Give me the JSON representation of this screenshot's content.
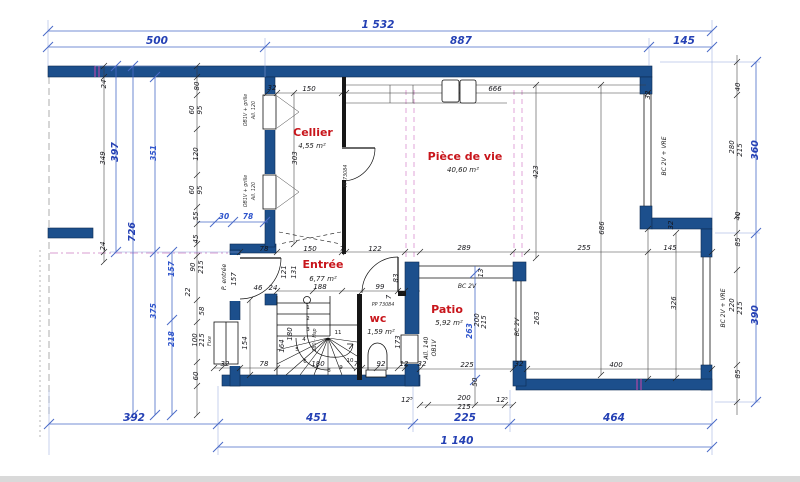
{
  "drawing_type": "floor-plan",
  "colors": {
    "wall": "#1c4f8c",
    "dimension_blue": "#2440b4",
    "room_label_red": "#c8151b"
  },
  "rooms": [
    {
      "name": "Cellier",
      "area": "4,55 m²"
    },
    {
      "name": "Pièce de vie",
      "area": "40,60 m²"
    },
    {
      "name": "Entrée",
      "area": "6,77 m²"
    },
    {
      "name": "wc",
      "area": "1,59 m²"
    },
    {
      "name": "Patio",
      "area": "5,92 m²"
    }
  ],
  "annotations": [
    {
      "t": "1 532",
      "x": 378,
      "y": 28,
      "c": "maj"
    },
    {
      "t": "500",
      "x": 157,
      "y": 44,
      "c": "maj"
    },
    {
      "t": "887",
      "x": 461,
      "y": 44,
      "c": "maj"
    },
    {
      "t": "145",
      "x": 684,
      "y": 44,
      "c": "maj"
    },
    {
      "t": "392",
      "x": 134,
      "y": 421,
      "c": "maj"
    },
    {
      "t": "451",
      "x": 317,
      "y": 421,
      "c": "maj"
    },
    {
      "t": "225",
      "x": 465,
      "y": 421,
      "c": "maj"
    },
    {
      "t": "464",
      "x": 614,
      "y": 421,
      "c": "maj"
    },
    {
      "t": "1 140",
      "x": 457,
      "y": 444,
      "c": "maj"
    },
    {
      "t": "397",
      "x": 118,
      "y": 152,
      "r": -90,
      "c": "majv"
    },
    {
      "t": "726",
      "x": 135,
      "y": 232,
      "r": -90,
      "c": "majv"
    },
    {
      "t": "360",
      "x": 758,
      "y": 150,
      "r": -90,
      "c": "majv"
    },
    {
      "t": "390",
      "x": 758,
      "y": 315,
      "r": -90,
      "c": "majv"
    },
    {
      "t": "351",
      "x": 156,
      "y": 153,
      "r": -90,
      "c": "blu"
    },
    {
      "t": "157",
      "x": 174,
      "y": 269,
      "r": -90,
      "c": "blu"
    },
    {
      "t": "375",
      "x": 156,
      "y": 311,
      "r": -90,
      "c": "blu"
    },
    {
      "t": "218",
      "x": 174,
      "y": 339,
      "r": -90,
      "c": "blu"
    },
    {
      "t": "30",
      "x": 224,
      "y": 219,
      "c": "blu"
    },
    {
      "t": "78",
      "x": 248,
      "y": 219,
      "c": "blu"
    },
    {
      "t": "263",
      "x": 472,
      "y": 331,
      "r": -90,
      "c": "blu"
    },
    {
      "t": "24",
      "x": 106,
      "y": 84,
      "r": -90,
      "c": "dim"
    },
    {
      "t": "349",
      "x": 105,
      "y": 158,
      "r": -90,
      "c": "dim"
    },
    {
      "t": "24",
      "x": 105,
      "y": 246,
      "r": -90,
      "c": "dim"
    },
    {
      "t": "80",
      "x": 199,
      "y": 86,
      "r": -90,
      "c": "dim"
    },
    {
      "t": "60",
      "x": 194,
      "y": 110,
      "r": -90,
      "c": "dim"
    },
    {
      "t": "95",
      "x": 202,
      "y": 110,
      "r": -90,
      "c": "dim"
    },
    {
      "t": "120",
      "x": 198,
      "y": 154,
      "r": -90,
      "c": "dim"
    },
    {
      "t": "60",
      "x": 194,
      "y": 190,
      "r": -90,
      "c": "dim"
    },
    {
      "t": "95",
      "x": 202,
      "y": 190,
      "r": -90,
      "c": "dim"
    },
    {
      "t": "55",
      "x": 198,
      "y": 216,
      "r": -90,
      "c": "dim"
    },
    {
      "t": "45",
      "x": 198,
      "y": 239,
      "r": -90,
      "c": "dim"
    },
    {
      "t": "90",
      "x": 195,
      "y": 267,
      "r": -90,
      "c": "dim"
    },
    {
      "t": "215",
      "x": 203,
      "y": 267,
      "r": -90,
      "c": "dim"
    },
    {
      "t": "22",
      "x": 190,
      "y": 292,
      "r": -90,
      "c": "dim"
    },
    {
      "t": "58",
      "x": 204,
      "y": 311,
      "r": -90,
      "c": "dim"
    },
    {
      "t": "100",
      "x": 197,
      "y": 340,
      "r": -90,
      "c": "dim"
    },
    {
      "t": "215",
      "x": 204,
      "y": 340,
      "r": -90,
      "c": "dim"
    },
    {
      "t": "60",
      "x": 198,
      "y": 376,
      "r": -90,
      "c": "dim"
    },
    {
      "t": "40",
      "x": 740,
      "y": 87,
      "r": -90,
      "c": "dim"
    },
    {
      "t": "280",
      "x": 734,
      "y": 147,
      "r": -90,
      "c": "dim"
    },
    {
      "t": "215",
      "x": 742,
      "y": 150,
      "r": -90,
      "c": "dim"
    },
    {
      "t": "40",
      "x": 740,
      "y": 216,
      "r": -90,
      "c": "dim"
    },
    {
      "t": "85",
      "x": 740,
      "y": 242,
      "r": -90,
      "c": "dim"
    },
    {
      "t": "220",
      "x": 734,
      "y": 305,
      "r": -90,
      "c": "dim"
    },
    {
      "t": "215",
      "x": 742,
      "y": 308,
      "r": -90,
      "c": "dim"
    },
    {
      "t": "85",
      "x": 740,
      "y": 374,
      "r": -90,
      "c": "dim"
    },
    {
      "t": "32",
      "x": 272,
      "y": 90,
      "c": "dim"
    },
    {
      "t": "150",
      "x": 309,
      "y": 91,
      "c": "dim"
    },
    {
      "t": "7",
      "x": 344,
      "y": 91,
      "c": "dim"
    },
    {
      "t": "666",
      "x": 495,
      "y": 91,
      "c": "dim"
    },
    {
      "t": "303",
      "x": 297,
      "y": 158,
      "r": -90,
      "c": "dim"
    },
    {
      "t": "423",
      "x": 538,
      "y": 172,
      "r": -90,
      "c": "dim"
    },
    {
      "t": "686",
      "x": 604,
      "y": 228,
      "r": -90,
      "c": "dim"
    },
    {
      "t": "32",
      "x": 650,
      "y": 95,
      "r": -90,
      "c": "dim"
    },
    {
      "t": "32",
      "x": 673,
      "y": 225,
      "r": -90,
      "c": "dim"
    },
    {
      "t": "145",
      "x": 670,
      "y": 250,
      "c": "dim"
    },
    {
      "t": "326",
      "x": 676,
      "y": 303,
      "r": -90,
      "c": "dim"
    },
    {
      "t": "78",
      "x": 264,
      "y": 251,
      "c": "dim"
    },
    {
      "t": "150",
      "x": 310,
      "y": 251,
      "c": "dim"
    },
    {
      "t": "7",
      "x": 342,
      "y": 251,
      "c": "dim"
    },
    {
      "t": "122",
      "x": 375,
      "y": 251,
      "c": "dim"
    },
    {
      "t": "289",
      "x": 464,
      "y": 250,
      "c": "dim"
    },
    {
      "t": "255",
      "x": 584,
      "y": 250,
      "c": "dim"
    },
    {
      "t": "188",
      "x": 320,
      "y": 289,
      "c": "dim"
    },
    {
      "t": "99",
      "x": 380,
      "y": 289,
      "c": "dim"
    },
    {
      "t": "83",
      "x": 398,
      "y": 278,
      "r": -90,
      "c": "dim"
    },
    {
      "t": "7",
      "x": 391,
      "y": 297,
      "r": -90,
      "c": "dim"
    },
    {
      "t": "46",
      "x": 258,
      "y": 290,
      "c": "dim"
    },
    {
      "t": "24",
      "x": 273,
      "y": 290,
      "c": "dim"
    },
    {
      "t": "121",
      "x": 286,
      "y": 272,
      "r": -90,
      "c": "dim"
    },
    {
      "t": "131",
      "x": 296,
      "y": 272,
      "r": -90,
      "c": "dim"
    },
    {
      "t": "157",
      "x": 236,
      "y": 279,
      "r": -90,
      "c": "dim"
    },
    {
      "t": "154",
      "x": 247,
      "y": 343,
      "r": -90,
      "c": "dim"
    },
    {
      "t": "164",
      "x": 284,
      "y": 346,
      "r": -90,
      "c": "dim"
    },
    {
      "t": "180",
      "x": 292,
      "y": 334,
      "r": -90,
      "c": "dim"
    },
    {
      "t": "32",
      "x": 225,
      "y": 366,
      "c": "dim"
    },
    {
      "t": "78",
      "x": 264,
      "y": 366,
      "c": "dim"
    },
    {
      "t": "180",
      "x": 318,
      "y": 366,
      "c": "dim"
    },
    {
      "t": "7",
      "x": 356,
      "y": 366,
      "c": "dim"
    },
    {
      "t": "92",
      "x": 381,
      "y": 366,
      "c": "dim"
    },
    {
      "t": "12",
      "x": 404,
      "y": 366,
      "c": "dim"
    },
    {
      "t": "173",
      "x": 400,
      "y": 342,
      "r": -90,
      "c": "dim"
    },
    {
      "t": "13",
      "x": 483,
      "y": 273,
      "r": -90,
      "c": "dim"
    },
    {
      "t": "200",
      "x": 479,
      "y": 320,
      "r": -90,
      "c": "dim"
    },
    {
      "t": "215",
      "x": 486,
      "y": 322,
      "r": -90,
      "c": "dim"
    },
    {
      "t": "263",
      "x": 539,
      "y": 318,
      "r": -90,
      "c": "dim"
    },
    {
      "t": "225",
      "x": 467,
      "y": 367,
      "c": "dim"
    },
    {
      "t": "32",
      "x": 422,
      "y": 366,
      "c": "dim"
    },
    {
      "t": "32",
      "x": 519,
      "y": 366,
      "c": "dim"
    },
    {
      "t": "400",
      "x": 616,
      "y": 367,
      "c": "dim"
    },
    {
      "t": "50",
      "x": 477,
      "y": 382,
      "r": -90,
      "c": "dim"
    },
    {
      "t": "12⁵",
      "x": 407,
      "y": 402,
      "c": "dim"
    },
    {
      "t": "200",
      "x": 464,
      "y": 400,
      "c": "dim"
    },
    {
      "t": "215",
      "x": 464,
      "y": 409,
      "c": "dim"
    },
    {
      "t": "12⁵",
      "x": 502,
      "y": 402,
      "c": "dim"
    },
    {
      "t": "PP 73084",
      "x": 347,
      "y": 176,
      "r": -90,
      "c": "tiny"
    },
    {
      "t": "PP 73084",
      "x": 383,
      "y": 306,
      "c": "tiny"
    },
    {
      "t": "OB1V + grille",
      "x": 247,
      "y": 110,
      "r": -90,
      "c": "tiny"
    },
    {
      "t": "All. 120",
      "x": 255,
      "y": 110,
      "r": -90,
      "c": "tiny"
    },
    {
      "t": "OB1V + grille",
      "x": 247,
      "y": 191,
      "r": -90,
      "c": "tiny"
    },
    {
      "t": "All. 120",
      "x": 255,
      "y": 191,
      "r": -90,
      "c": "tiny"
    },
    {
      "t": "Fixe",
      "x": 211,
      "y": 341,
      "r": -90,
      "c": "tiny"
    },
    {
      "t": "180 - Hsp",
      "x": 316,
      "y": 340,
      "r": -90,
      "c": "tiny"
    },
    {
      "t": "P. entrée",
      "x": 226,
      "y": 277,
      "r": -90,
      "c": "lbl"
    },
    {
      "t": "BC 2V + VRE",
      "x": 666,
      "y": 156,
      "r": -90,
      "c": "lbl"
    },
    {
      "t": "BC 2V + VRE",
      "x": 725,
      "y": 308,
      "r": -90,
      "c": "lbl"
    },
    {
      "t": "BC 2V",
      "x": 467,
      "y": 288,
      "c": "lbl"
    },
    {
      "t": "BC 2V",
      "x": 519,
      "y": 327,
      "r": -90,
      "c": "lbl"
    },
    {
      "t": "All. 140",
      "x": 428,
      "y": 348,
      "r": -90,
      "c": "lbl"
    },
    {
      "t": "OB1V",
      "x": 436,
      "y": 348,
      "r": -90,
      "c": "lbl"
    },
    {
      "t": "1",
      "x": 308,
      "y": 309,
      "c": "num"
    },
    {
      "t": "2",
      "x": 308,
      "y": 320,
      "c": "num"
    },
    {
      "t": "3",
      "x": 308,
      "y": 331,
      "c": "num"
    },
    {
      "t": "4",
      "x": 304,
      "y": 341,
      "c": "num"
    },
    {
      "t": "5",
      "x": 297,
      "y": 351,
      "c": "num"
    },
    {
      "t": "6",
      "x": 305,
      "y": 363,
      "c": "num"
    },
    {
      "t": "7",
      "x": 317,
      "y": 370,
      "c": "num"
    },
    {
      "t": "8",
      "x": 329,
      "y": 372,
      "c": "num"
    },
    {
      "t": "9",
      "x": 341,
      "y": 369,
      "c": "num"
    },
    {
      "t": "10",
      "x": 350,
      "y": 362,
      "c": "num"
    },
    {
      "t": "11",
      "x": 338,
      "y": 334,
      "c": "num"
    }
  ]
}
